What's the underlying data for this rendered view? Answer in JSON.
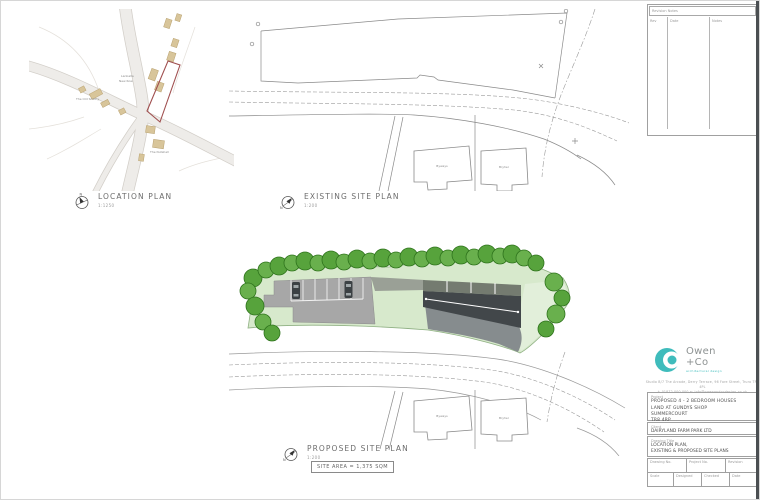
{
  "colors": {
    "accent_teal": "#3fbcbc",
    "tree_green": "#57a33c",
    "tree_green_alt": "#69b04d",
    "grass_green": "#d7e9cc",
    "tarmac_gray": "#a7a7a7",
    "roof_dark": "#42474a",
    "roof_band": "#747b70",
    "building_tan": "#d8c59a",
    "site_outline_red": "#a04f4f",
    "drawing_line": "#8a8a8a"
  },
  "plans": {
    "compass_n": "N",
    "location": {
      "title": "LOCATION PLAN",
      "scale": "1:1250",
      "labels": {
        "building_left": "The Old Smithy",
        "building_bottom": "The Nutshell",
        "small_1": "Lanballa",
        "small_2": "New Row"
      }
    },
    "existing": {
      "title": "EXISTING SITE PLAN",
      "scale": "1:200",
      "labels": {
        "house_1": "Byways",
        "house_2": "Bryher"
      }
    },
    "proposed": {
      "title": "PROPOSED SITE PLAN",
      "scale": "1:200",
      "site_area": "SITE AREA = 1,375 SQM"
    }
  },
  "titleblock": {
    "revision_table": {
      "title": "Revision Notes",
      "col_rev": "Rev",
      "col_date": "Date",
      "col_notes": "Notes"
    },
    "logo": {
      "line1": "Owen",
      "line2": "+Co",
      "tagline": "architectural design"
    },
    "address_line1": "Studio B/7 The Arcade, Derry Terrace, 96 Fore Street, Truro TR1 4PL",
    "address_line2": "t: 01872 000 000    e: info@owenandcodesign.co.uk",
    "project": {
      "label": "Project",
      "line1": "PROPOSED 4 - 2 BEDROOM HOUSES",
      "line2": "LAND AT GUNDYS SHOP",
      "line3": "SUMMERCOURT",
      "line4": "TR8 4RP"
    },
    "client": {
      "label": "Client",
      "value": "DAIRYLAND FARM PARK LTD"
    },
    "drawing_title": {
      "label": "Drawing Title",
      "line1": "LOCATION PLAN,",
      "line2": "EXISTING & PROPOSED SITE PLANS"
    },
    "fields": {
      "drawing_no_label": "Drawing No.",
      "drawing_no": "AB.SHD.04",
      "project_no_label": "Project No.",
      "project_no": "DWG/88 01",
      "revision_label": "Revision",
      "revision": "-",
      "scale_label": "Scale",
      "scale": "1:75",
      "designed_label": "Designed",
      "designed": "PDA JUL",
      "checked_label": "Checked",
      "checked": "ESD",
      "date_label": "Date",
      "date": "FEB 21"
    }
  }
}
